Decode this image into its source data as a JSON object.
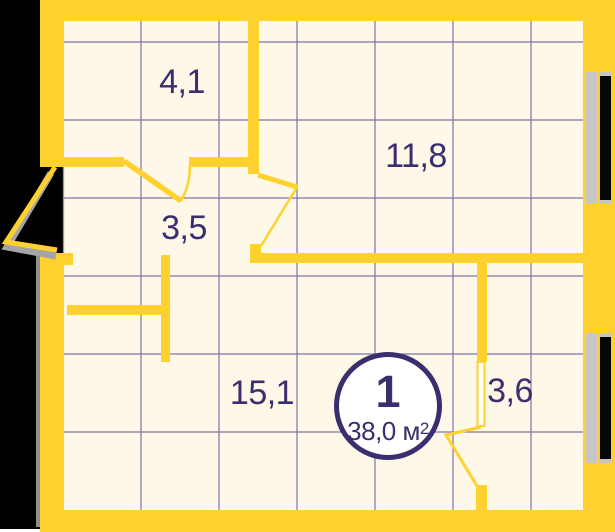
{
  "plan": {
    "title": "apartment-floor-plan",
    "unit_badge": {
      "number": "1",
      "area_label": "38,0 м²",
      "area_main": "38,0 м",
      "area_sup": "2"
    },
    "rooms": [
      {
        "id": "room-top-left",
        "area": "4,1"
      },
      {
        "id": "room-top-right",
        "area": "11,8"
      },
      {
        "id": "room-hallway",
        "area": "3,5"
      },
      {
        "id": "room-bottom-main",
        "area": "15,1"
      },
      {
        "id": "room-bottom-right",
        "area": "3,6"
      }
    ],
    "windows": [
      {
        "id": "window-right-top"
      },
      {
        "id": "window-right-bottom"
      }
    ],
    "doors": [
      {
        "id": "entrance-door-left"
      },
      {
        "id": "door-hallway-top"
      },
      {
        "id": "door-hallway-livingroom"
      },
      {
        "id": "door-bathroom"
      }
    ],
    "colors": {
      "wall_yellow": "#FFD12E",
      "interior_cream": "#FDF8E8",
      "grid_purple": "#8075A6",
      "text_indigo": "#3B2D6E",
      "outside_black": "#000000",
      "window_glass": "#060606",
      "window_frame_gray": "#C6C6C6",
      "shadow_gray": "#A5A5A5"
    }
  }
}
